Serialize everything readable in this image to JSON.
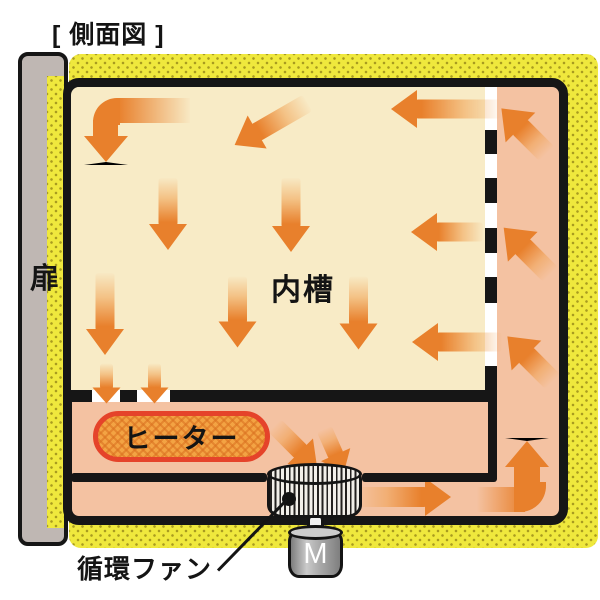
{
  "title": "[ 側面図 ]",
  "labels": {
    "door": "扉",
    "inner_chamber": "内槽",
    "heater": "ヒーター",
    "circulation_fan": "循環ファン",
    "motor": "M"
  },
  "colors": {
    "insulation": "#EFE83D",
    "insulation_dot": "#A89B20",
    "duct": "#F4C2A2",
    "chamber": "#F8EBC6",
    "outline": "#161616",
    "arrow": "#E8802C",
    "heater_fill": "#F3A343",
    "heater_border": "#E5432A",
    "door": "#BFB7B3",
    "motor": "#9A9A9A"
  },
  "arrows": [
    {
      "name": "ceiling-inflow",
      "cx": 446,
      "cy": 109,
      "len": 110,
      "rot": 180,
      "sw": 19,
      "hw": 38,
      "hl": 26
    },
    {
      "name": "ceiling-diagonal",
      "cx": 271,
      "cy": 124,
      "len": 84,
      "rot": 150,
      "sw": 19,
      "hw": 38,
      "hl": 26
    },
    {
      "name": "chamber-down-1",
      "cx": 168,
      "cy": 214,
      "len": 72,
      "rot": 90,
      "sw": 19,
      "hw": 38,
      "hl": 26
    },
    {
      "name": "chamber-down-2",
      "cx": 291,
      "cy": 215,
      "len": 74,
      "rot": 90,
      "sw": 19,
      "hw": 38,
      "hl": 26
    },
    {
      "name": "side-inflow-upper",
      "cx": 447,
      "cy": 232,
      "len": 72,
      "rot": 180,
      "sw": 19,
      "hw": 38,
      "hl": 26
    },
    {
      "name": "chamber-down-3",
      "cx": 105,
      "cy": 314,
      "len": 82,
      "rot": 90,
      "sw": 19,
      "hw": 38,
      "hl": 26
    },
    {
      "name": "chamber-down-4",
      "cx": 237,
      "cy": 312,
      "len": 71,
      "rot": 90,
      "sw": 19,
      "hw": 38,
      "hl": 26
    },
    {
      "name": "chamber-down-5",
      "cx": 358,
      "cy": 313,
      "len": 73,
      "rot": 90,
      "sw": 19,
      "hw": 38,
      "hl": 26
    },
    {
      "name": "side-inflow-lower",
      "cx": 457,
      "cy": 342,
      "len": 90,
      "rot": 180,
      "sw": 19,
      "hw": 38,
      "hl": 26
    },
    {
      "name": "floor-outflow-1",
      "cx": 107,
      "cy": 383,
      "len": 40,
      "rot": 90,
      "sw": 13,
      "hw": 29,
      "hl": 16
    },
    {
      "name": "floor-outflow-2",
      "cx": 155,
      "cy": 383,
      "len": 40,
      "rot": 90,
      "sw": 13,
      "hw": 29,
      "hl": 16
    },
    {
      "name": "duct-rise-1",
      "cx": 524,
      "cy": 131,
      "len": 64,
      "rot": 225,
      "sw": 21,
      "hw": 42,
      "hl": 27
    },
    {
      "name": "duct-rise-2",
      "cx": 527,
      "cy": 251,
      "len": 66,
      "rot": 225,
      "sw": 21,
      "hw": 42,
      "hl": 27
    },
    {
      "name": "duct-rise-3",
      "cx": 530,
      "cy": 359,
      "len": 64,
      "rot": 225,
      "sw": 21,
      "hw": 42,
      "hl": 27
    },
    {
      "name": "into-fan-1",
      "cx": 296,
      "cy": 447,
      "len": 60,
      "rot": 45,
      "sw": 18,
      "hw": 36,
      "hl": 24
    },
    {
      "name": "into-fan-2",
      "cx": 334,
      "cy": 451,
      "len": 48,
      "rot": 66,
      "sw": 16,
      "hw": 32,
      "hl": 20
    },
    {
      "name": "fan-outflow",
      "cx": 404,
      "cy": 497,
      "len": 94,
      "rot": 0,
      "sw": 20,
      "hw": 38,
      "hl": 26,
      "z": 4
    }
  ],
  "walls": {
    "vertical_dashes": [
      {
        "y": 130,
        "h": 24
      },
      {
        "y": 178,
        "h": 25
      },
      {
        "y": 228,
        "h": 25
      },
      {
        "y": 277,
        "h": 26
      },
      {
        "y": 366,
        "h": 36
      }
    ],
    "bottom_wall_segments": [
      {
        "x": 71,
        "w": 21
      },
      {
        "x": 120,
        "w": 17
      },
      {
        "x": 170,
        "w": 327
      }
    ]
  }
}
